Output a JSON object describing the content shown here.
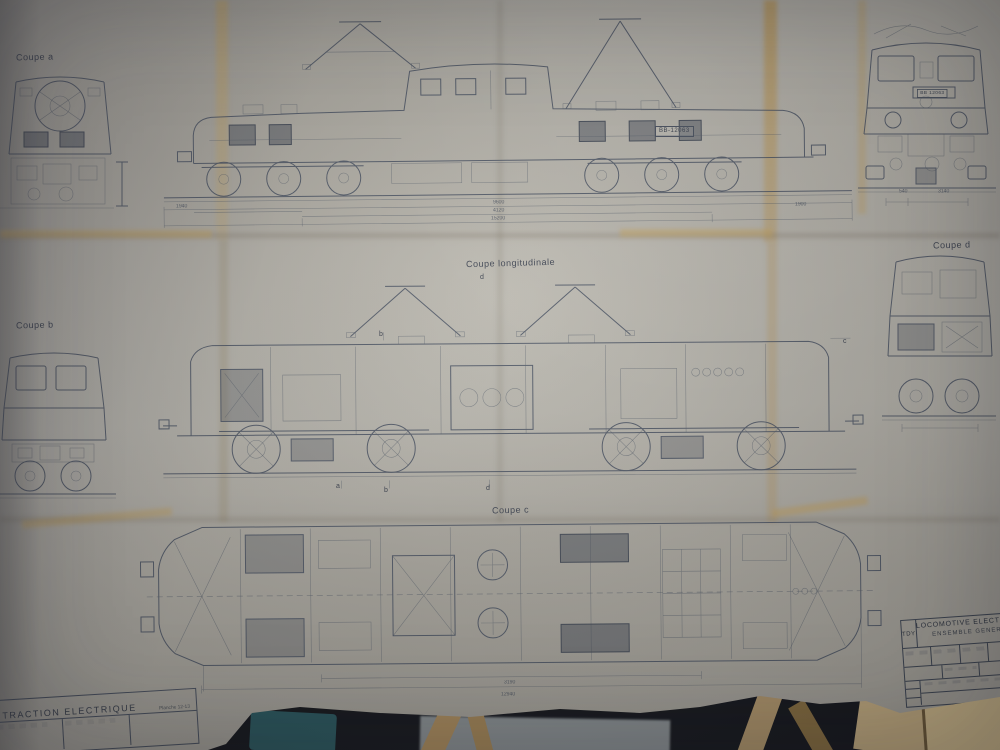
{
  "labels": {
    "coupe_a": "Coupe a",
    "coupe_b": "Coupe b",
    "coupe_c": "Coupe c",
    "coupe_d": "Coupe d",
    "coupe_longitudinale": "Coupe longitudinale"
  },
  "markers": {
    "top_d": "d",
    "mid_b": "b",
    "mid_c": "c",
    "bottom_a": "a",
    "bottom_b": "b",
    "bottom_d": "d"
  },
  "plates": {
    "side_number": "BB-12063",
    "front_number": "BB 12063"
  },
  "dimensions": {
    "top_center": [
      "9600",
      "4120",
      "15200"
    ],
    "top_left_end": "1940",
    "top_right_end": "1900",
    "front_right_a": "540",
    "front_right_b": "3140",
    "bottom_a": "3190",
    "bottom_b": "12940"
  },
  "title_block": {
    "line1": "LOCOMOTIVE ELECTRIQUE",
    "line2": "ENSEMBLE GENERAL",
    "ref": "TDY"
  },
  "footer": {
    "title": "TRACTION ELECTRIQUE",
    "subtitle": "Planche 12-13"
  },
  "colors": {
    "paper": "#b5b2a9",
    "ink": "#47505e",
    "stain": "#c7a96f",
    "background_dark": "#15171c",
    "teal_object": "#2b5a60"
  }
}
